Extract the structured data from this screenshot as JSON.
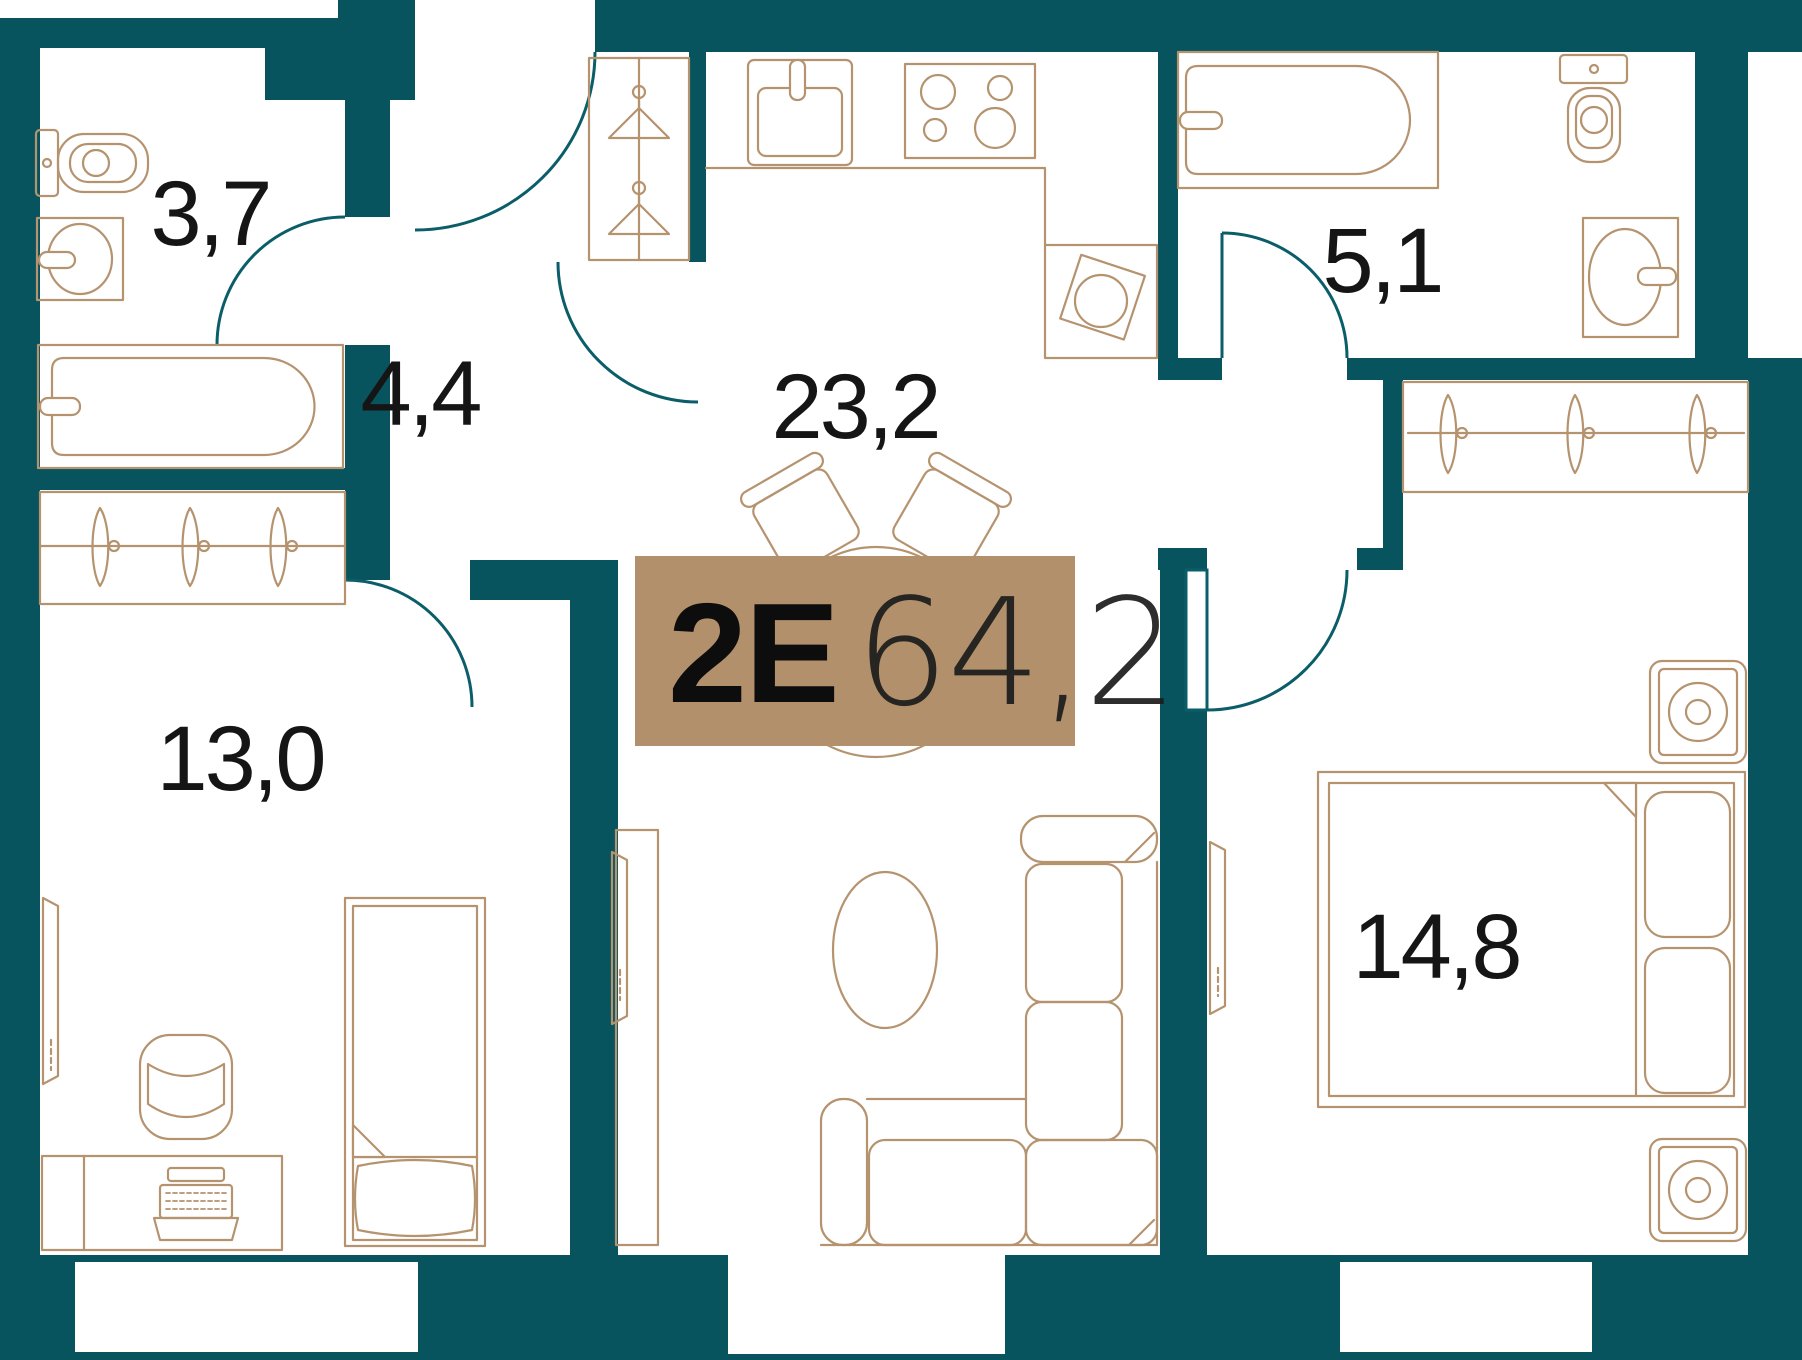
{
  "floor_plan": {
    "badge": {
      "unit_type": "2E",
      "total_area": "64,2"
    },
    "rooms": [
      {
        "id": "bathroom-1",
        "area": "3,7"
      },
      {
        "id": "hallway",
        "area": "4,4"
      },
      {
        "id": "kitchen-living",
        "area": "23,2"
      },
      {
        "id": "bathroom-2",
        "area": "5,1"
      },
      {
        "id": "bedroom-1",
        "area": "13,0"
      },
      {
        "id": "bedroom-2",
        "area": "14,8"
      }
    ],
    "colors": {
      "wall": "#07545f",
      "door_arc": "#0b5e69",
      "furniture": "#b5936f",
      "badge_bg": "#b3906c",
      "label": "#151515",
      "bg": "#ffffff"
    }
  }
}
